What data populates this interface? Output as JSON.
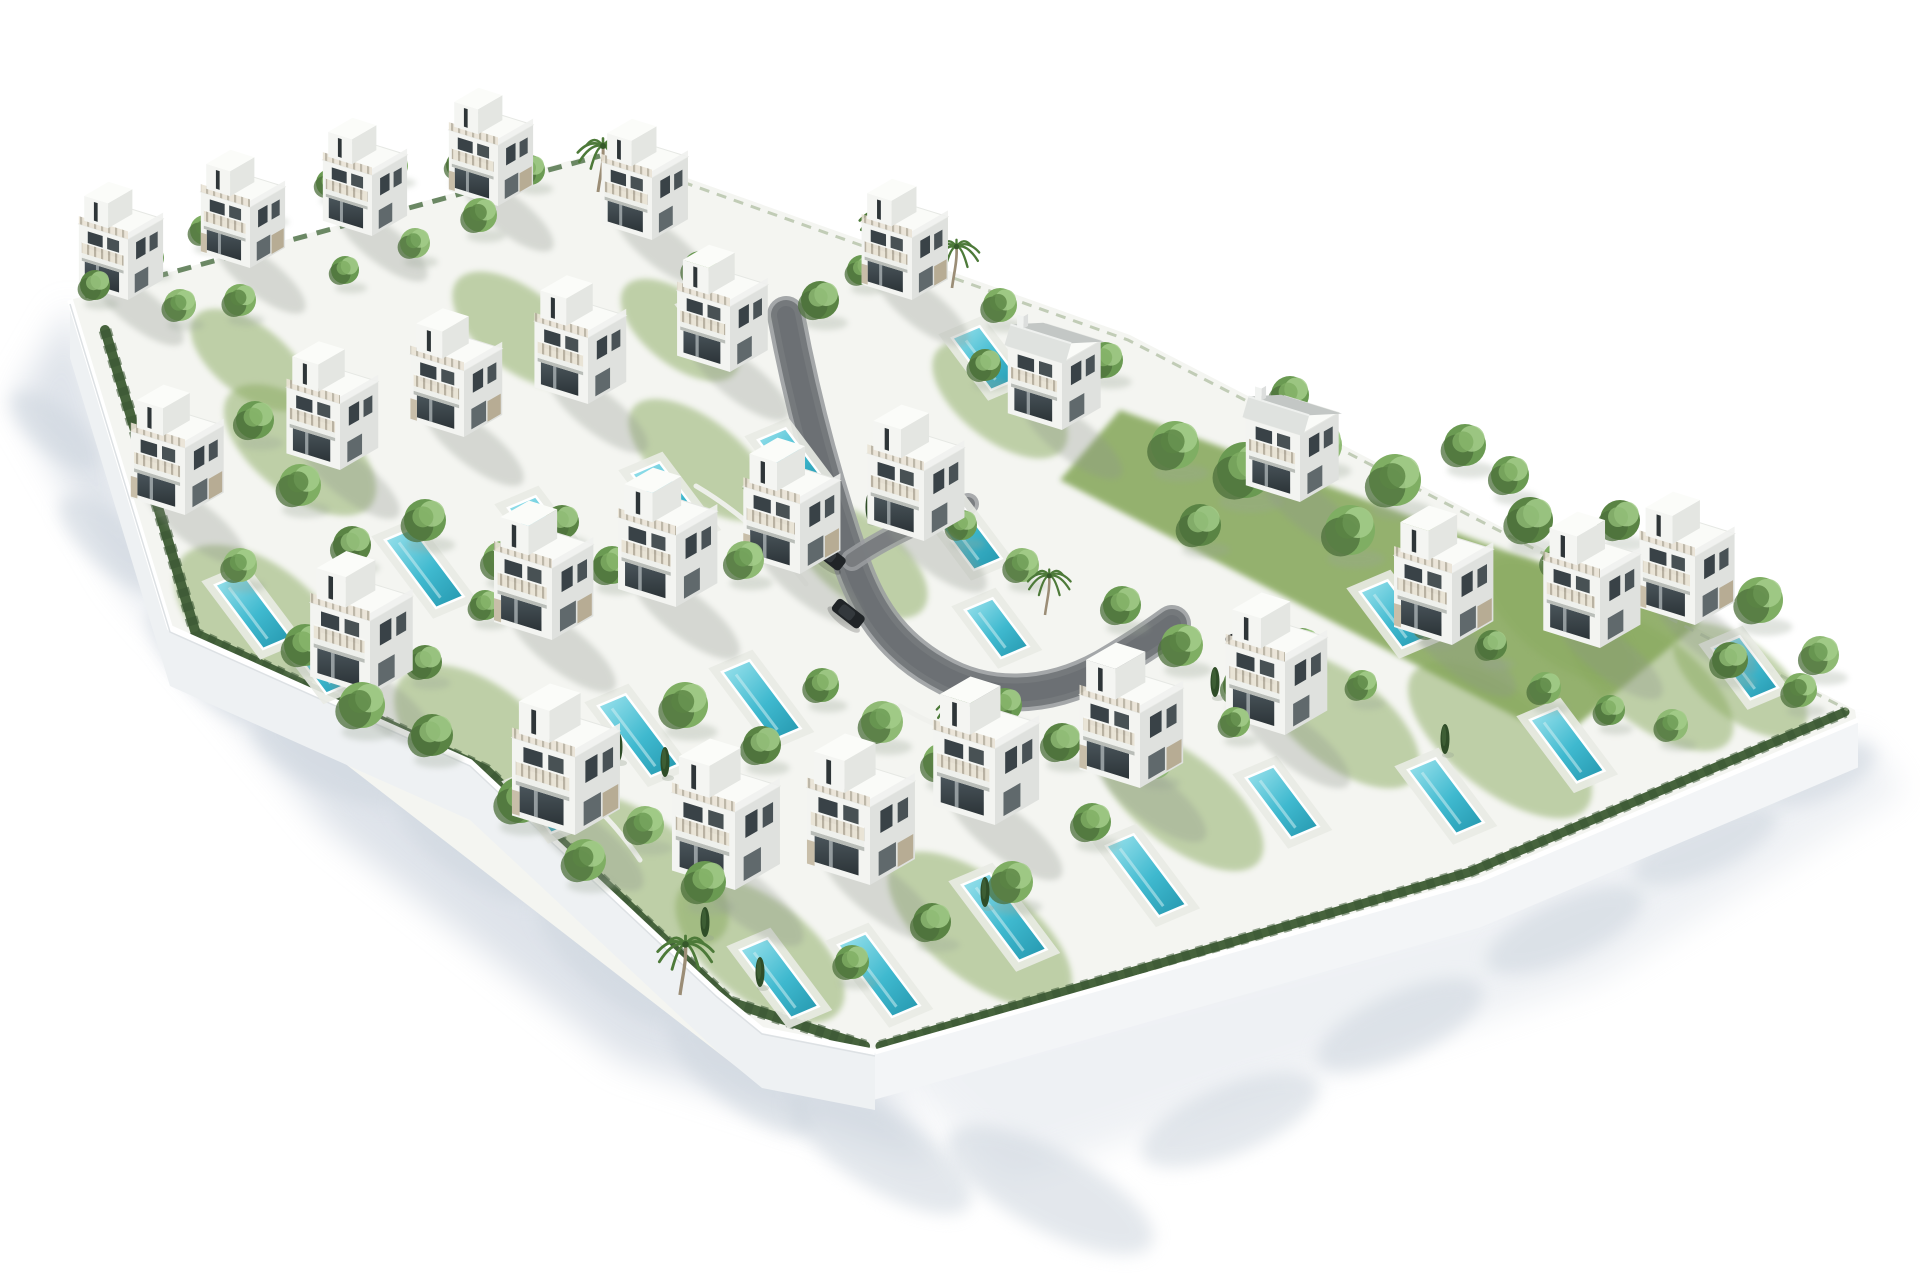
{
  "scene": {
    "description": "Aerial 3D architectural rendering of a walled residential development with 27 modern white villas, private turquoise pools, gardens, trees, palms and a curved internal road, on a white background",
    "canvas": {
      "w": 1920,
      "h": 1280,
      "background": "#ffffff"
    },
    "palette": {
      "ground": "#f4f5f1",
      "lawn": "#8aaa61",
      "lawn_dark": "#6d9150",
      "wall_face": "#eef1f3",
      "wall_face2": "#f3f5f7",
      "wall_top": "#ffffff",
      "shadow": "#d7dde5",
      "shadow_soft": "#cdd5de",
      "road": "#75797c",
      "road_edge": "#9b9ea1",
      "road_dark": "#64686b",
      "pool_deck": "#e9ebe4",
      "villa_left": "#f3f4f1",
      "villa_right": "#dfe1de",
      "villa_roof": "#fafbf8",
      "glass_dark": "#394247",
      "stone": "#b3a68c",
      "stone2": "#c0b49c",
      "metal_roof": "#c3c7c5",
      "metal_roof_light": "#dfe2df",
      "tree_greens": [
        "#6a9a52",
        "#7fae63",
        "#5a8444",
        "#8fba74"
      ],
      "tree_shade": "#4c6f3b",
      "tree_light": "#a3cc8a",
      "hedge": "#46633c",
      "hedge_dark": "#3b5733",
      "cypress": "#2f4d28",
      "palm_frond": "#4d7a39",
      "palm_trunk": "#9b8d76",
      "car_body": "#202427",
      "car_roof": "#33383c"
    },
    "plot": {
      "outline": [
        [
          70,
          300
        ],
        [
          608,
          150
        ],
        [
          1130,
          335
        ],
        [
          1855,
          710
        ],
        [
          1858,
          730
        ],
        [
          1480,
          895
        ],
        [
          875,
          1080
        ],
        [
          738,
          1068
        ],
        [
          170,
          628
        ]
      ]
    },
    "walls": {
      "height": 58,
      "sw_top": [
        [
          70,
          300
        ],
        [
          170,
          628
        ],
        [
          470,
          762
        ],
        [
          717,
          993
        ],
        [
          762,
          1030
        ],
        [
          875,
          1052
        ]
      ],
      "se_top": [
        [
          875,
          1052
        ],
        [
          1480,
          880
        ],
        [
          1858,
          720
        ]
      ]
    },
    "hedges": {
      "sw": [
        [
          105,
          330
        ],
        [
          196,
          634
        ],
        [
          486,
          770
        ],
        [
          730,
          1002
        ],
        [
          865,
          1046
        ]
      ],
      "se": [
        [
          880,
          1046
        ],
        [
          1470,
          872
        ],
        [
          1845,
          712
        ]
      ],
      "nw": [
        [
          85,
          296
        ],
        [
          600,
          156
        ]
      ],
      "ne": [
        [
          615,
          158
        ],
        [
          1128,
          340
        ],
        [
          1848,
          710
        ]
      ]
    },
    "road": {
      "main": "M786,315 C800,390 820,470 850,558 C866,606 890,645 938,672 C986,700 1046,700 1104,668 C1128,654 1150,640 1172,624",
      "branch": "M852,560 C884,538 926,518 968,504",
      "garden_walls": [
        "M696,486 Q760,524 806,584",
        "M900,706 Q962,744 1034,744",
        "M536,760 Q600,800 640,860"
      ]
    },
    "villas": [
      [
        128,
        300,
        0.78,
        0
      ],
      [
        250,
        268,
        0.78,
        1
      ],
      [
        372,
        236,
        0.78,
        0
      ],
      [
        498,
        206,
        0.78,
        1
      ],
      [
        652,
        240,
        0.8,
        0
      ],
      [
        912,
        300,
        0.8,
        1
      ],
      [
        185,
        515,
        0.86,
        1
      ],
      [
        340,
        470,
        0.85,
        0
      ],
      [
        464,
        437,
        0.85,
        1
      ],
      [
        588,
        404,
        0.85,
        0
      ],
      [
        730,
        372,
        0.84,
        0
      ],
      [
        1062,
        430,
        0.86,
        2
      ],
      [
        370,
        695,
        0.95,
        0
      ],
      [
        552,
        640,
        0.92,
        1
      ],
      [
        676,
        607,
        0.92,
        0
      ],
      [
        800,
        574,
        0.9,
        1
      ],
      [
        924,
        541,
        0.9,
        0
      ],
      [
        1300,
        502,
        0.86,
        2
      ],
      [
        575,
        835,
        1.0,
        1
      ],
      [
        735,
        890,
        1.0,
        0
      ],
      [
        870,
        885,
        1.0,
        1
      ],
      [
        995,
        825,
        0.98,
        0
      ],
      [
        1140,
        788,
        0.96,
        1
      ],
      [
        1285,
        735,
        0.94,
        0
      ],
      [
        1452,
        645,
        0.92,
        1
      ],
      [
        1600,
        648,
        0.9,
        0
      ],
      [
        1695,
        625,
        0.88,
        1
      ]
    ],
    "pools": [
      [
        688,
        308,
        60
      ],
      [
        952,
        338,
        65
      ],
      [
        215,
        585,
        80
      ],
      [
        385,
        540,
        85
      ],
      [
        508,
        508,
        85
      ],
      [
        632,
        474,
        80
      ],
      [
        758,
        440,
        60
      ],
      [
        920,
        498,
        90
      ],
      [
        295,
        652,
        52
      ],
      [
        598,
        706,
        88
      ],
      [
        722,
        672,
        85
      ],
      [
        965,
        610,
        60
      ],
      [
        1360,
        592,
        70
      ],
      [
        515,
        785,
        60
      ],
      [
        740,
        950,
        85
      ],
      [
        838,
        945,
        90
      ],
      [
        962,
        885,
        95
      ],
      [
        1106,
        846,
        88
      ],
      [
        1246,
        778,
        75
      ],
      [
        1408,
        770,
        80
      ],
      [
        1530,
        720,
        78
      ],
      [
        1712,
        648,
        64
      ]
    ],
    "lawn_quads": [
      [
        [
          1120,
          410
        ],
        [
          1700,
          622
        ],
        [
          1560,
          740
        ],
        [
          1060,
          480
        ]
      ]
    ],
    "garden_blobs": [
      [
        260,
        620,
        100,
        55
      ],
      [
        480,
        740,
        100,
        55
      ],
      [
        640,
        870,
        105,
        52
      ],
      [
        760,
        950,
        100,
        50
      ],
      [
        300,
        450,
        90,
        45
      ],
      [
        980,
        930,
        110,
        50
      ],
      [
        1180,
        800,
        100,
        45
      ],
      [
        1340,
        720,
        95,
        45
      ],
      [
        860,
        560,
        80,
        40
      ],
      [
        700,
        460,
        85,
        40
      ],
      [
        1500,
        740,
        110,
        50
      ],
      [
        1650,
        680,
        100,
        45
      ],
      [
        520,
        330,
        80,
        40
      ],
      [
        250,
        360,
        70,
        35
      ],
      [
        680,
        330,
        70,
        35
      ],
      [
        1000,
        400,
        80,
        40
      ],
      [
        1560,
        620,
        90,
        40
      ],
      [
        1740,
        680,
        80,
        38
      ]
    ],
    "trees": [
      [
        95,
        285,
        15,
        2
      ],
      [
        150,
        258,
        14,
        0
      ],
      [
        205,
        230,
        15,
        1
      ],
      [
        268,
        205,
        13,
        2
      ],
      [
        330,
        183,
        14,
        0
      ],
      [
        395,
        166,
        13,
        1
      ],
      [
        460,
        165,
        14,
        2
      ],
      [
        530,
        170,
        15,
        0
      ],
      [
        480,
        215,
        17,
        1
      ],
      [
        415,
        243,
        15,
        3
      ],
      [
        345,
        270,
        14,
        0
      ],
      [
        240,
        300,
        16,
        1
      ],
      [
        180,
        305,
        16,
        3
      ],
      [
        700,
        268,
        17,
        0
      ],
      [
        748,
        300,
        15,
        1
      ],
      [
        820,
        300,
        19,
        2
      ],
      [
        862,
        270,
        15,
        0
      ],
      [
        1000,
        305,
        17,
        1
      ],
      [
        1040,
        340,
        15,
        3
      ],
      [
        985,
        365,
        16,
        2
      ],
      [
        1105,
        360,
        18,
        0
      ],
      [
        1175,
        445,
        24,
        1
      ],
      [
        1245,
        470,
        28,
        0
      ],
      [
        1320,
        445,
        22,
        3
      ],
      [
        1395,
        480,
        26,
        1
      ],
      [
        1465,
        445,
        21,
        0
      ],
      [
        1530,
        520,
        23,
        2
      ],
      [
        1290,
        395,
        19,
        0
      ],
      [
        1350,
        530,
        25,
        1
      ],
      [
        1435,
        570,
        23,
        3
      ],
      [
        1200,
        525,
        21,
        2
      ],
      [
        1510,
        475,
        19,
        0
      ],
      [
        1560,
        560,
        18,
        1
      ],
      [
        1620,
        520,
        20,
        2
      ],
      [
        1690,
        560,
        22,
        0
      ],
      [
        1760,
        600,
        23,
        1
      ],
      [
        1820,
        655,
        19,
        3
      ],
      [
        1730,
        660,
        18,
        2
      ],
      [
        1800,
        690,
        17,
        1
      ],
      [
        255,
        420,
        19,
        0
      ],
      [
        300,
        485,
        21,
        1
      ],
      [
        352,
        545,
        19,
        2
      ],
      [
        240,
        565,
        17,
        3
      ],
      [
        425,
        520,
        21,
        0
      ],
      [
        502,
        560,
        19,
        1
      ],
      [
        562,
        522,
        17,
        2
      ],
      [
        612,
        565,
        19,
        0
      ],
      [
        688,
        525,
        17,
        1
      ],
      [
        745,
        560,
        19,
        3
      ],
      [
        305,
        645,
        21,
        0
      ],
      [
        362,
        705,
        23,
        1
      ],
      [
        432,
        735,
        21,
        2
      ],
      [
        520,
        800,
        23,
        0
      ],
      [
        585,
        860,
        21,
        1
      ],
      [
        645,
        825,
        19,
        3
      ],
      [
        705,
        882,
        21,
        0
      ],
      [
        425,
        662,
        17,
        2
      ],
      [
        485,
        605,
        15,
        0
      ],
      [
        685,
        705,
        23,
        1
      ],
      [
        762,
        745,
        19,
        2
      ],
      [
        822,
        685,
        17,
        0
      ],
      [
        882,
        722,
        21,
        3
      ],
      [
        942,
        762,
        19,
        1
      ],
      [
        1005,
        705,
        17,
        0
      ],
      [
        1062,
        742,
        19,
        2
      ],
      [
        905,
        485,
        17,
        1
      ],
      [
        962,
        525,
        15,
        0
      ],
      [
        1022,
        565,
        17,
        3
      ],
      [
        1122,
        605,
        19,
        0
      ],
      [
        1182,
        645,
        21,
        1
      ],
      [
        1242,
        685,
        19,
        2
      ],
      [
        1302,
        645,
        17,
        0
      ],
      [
        1362,
        685,
        15,
        1
      ],
      [
        1155,
        762,
        17,
        3
      ],
      [
        1092,
        822,
        19,
        0
      ],
      [
        1012,
        882,
        21,
        1
      ],
      [
        932,
        922,
        19,
        2
      ],
      [
        852,
        962,
        17,
        0
      ],
      [
        1235,
        722,
        15,
        1
      ],
      [
        1432,
        622,
        17,
        0
      ],
      [
        1492,
        645,
        15,
        2
      ],
      [
        1545,
        688,
        16,
        1
      ],
      [
        1610,
        710,
        15,
        0
      ],
      [
        1672,
        725,
        16,
        3
      ]
    ],
    "palms": [
      [
        598,
        192,
        1.0
      ],
      [
        634,
        225,
        0.9
      ],
      [
        880,
        260,
        1.0
      ],
      [
        952,
        288,
        0.9
      ],
      [
        760,
        520,
        0.8
      ],
      [
        1045,
        615,
        0.85
      ],
      [
        955,
        745,
        0.9
      ],
      [
        680,
        995,
        1.1
      ]
    ],
    "cypresses": [
      [
        665,
        775
      ],
      [
        705,
        935
      ],
      [
        1215,
        695
      ],
      [
        760,
        985
      ],
      [
        1120,
        760
      ],
      [
        548,
        802
      ],
      [
        985,
        905
      ],
      [
        1445,
        752
      ],
      [
        870,
        520
      ],
      [
        618,
        760
      ]
    ],
    "cars": [
      [
        829,
        556,
        38
      ],
      [
        848,
        614,
        38
      ],
      [
        1243,
        638,
        -22
      ]
    ],
    "ext_shadows": {
      "band": [
        [
          70,
          305
        ],
        [
          170,
          634
        ],
        [
          470,
          768
        ],
        [
          717,
          999
        ],
        [
          875,
          1058
        ],
        [
          935,
          1165
        ],
        [
          620,
          1060
        ],
        [
          330,
          830
        ],
        [
          120,
          580
        ],
        [
          15,
          400
        ]
      ],
      "right": [
        [
          875,
          1058
        ],
        [
          1480,
          898
        ],
        [
          1858,
          734
        ],
        [
          1905,
          790
        ],
        [
          1600,
          980
        ],
        [
          1010,
          1180
        ]
      ],
      "blobs": [
        [
          55,
          430,
          55,
          22,
          40
        ],
        [
          115,
          545,
          70,
          26,
          40
        ],
        [
          205,
          665,
          78,
          28,
          45
        ],
        [
          330,
          760,
          85,
          30,
          25
        ],
        [
          470,
          845,
          90,
          32,
          35
        ],
        [
          610,
          960,
          92,
          32,
          40
        ],
        [
          740,
          1075,
          90,
          30,
          38
        ],
        [
          880,
          1150,
          105,
          38,
          32
        ],
        [
          1050,
          1190,
          115,
          40,
          28
        ],
        [
          1230,
          1120,
          95,
          34,
          -22
        ],
        [
          1400,
          1025,
          90,
          32,
          -24
        ],
        [
          1565,
          930,
          85,
          30,
          -24
        ],
        [
          1705,
          845,
          78,
          28,
          -24
        ],
        [
          1820,
          775,
          60,
          24,
          -24
        ]
      ]
    }
  }
}
